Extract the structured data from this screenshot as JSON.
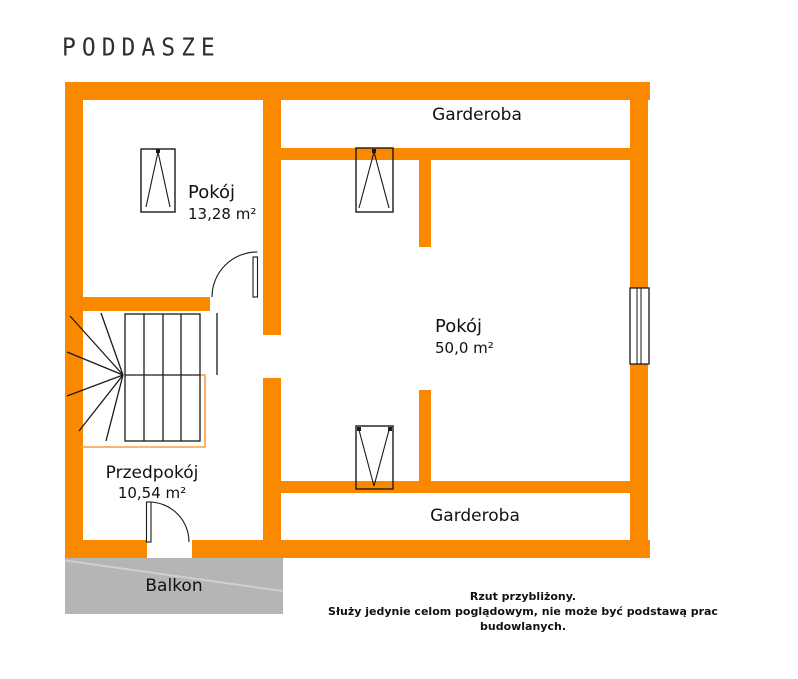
{
  "title": "PODDASZE",
  "rooms": {
    "pokoj1": {
      "name": "Pokój",
      "area": "13,28 m²"
    },
    "pokoj2": {
      "name": "Pokój",
      "area": "50,0 m²"
    },
    "przedpokoj": {
      "name": "Przedpokój",
      "area": "10,54 m²"
    },
    "garderoba_top": {
      "name": "Garderoba"
    },
    "garderoba_bottom": {
      "name": "Garderoba"
    },
    "balkon": {
      "name": "Balkon"
    }
  },
  "disclaimer": {
    "line1": "Rzut przybliżony.",
    "line2": "Służy jedynie celom poglądowym, nie może być podstawą prac budowlanych."
  },
  "colors": {
    "wall_orange": "#FB8900",
    "stairwell_outline_orange": "#F59F3F",
    "balcony_gray": "#B5B5B5",
    "linework_black": "#1A1A1A"
  }
}
